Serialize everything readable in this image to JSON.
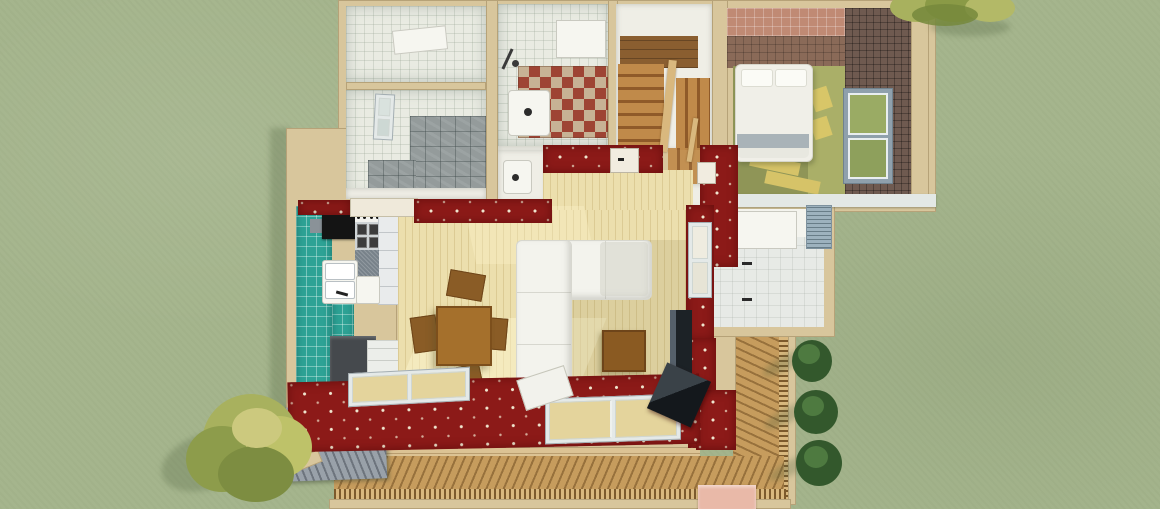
{
  "meta": {
    "title": "3D dollhouse top view rendering of a single-storey house on a lawn",
    "view": "top-down cutaway architectural render",
    "canvas": {
      "width": 1160,
      "height": 509
    }
  },
  "palette": {
    "grass": "#a5b58d",
    "wall_beige": "#d8c69c",
    "wall_white": "#efeee6",
    "red_wall": "#8c1a18",
    "red_dot": "#efe6cf",
    "tile_wall": "#e9ebe2",
    "stone_floor": "#949b9b",
    "teal_floor": "#2da295",
    "wood_floor": "#ecdfad",
    "bedroom_floor": "#8f9557",
    "bedroom_floor_light": "#aaaf68",
    "bedroom_wall": "#6f5a50",
    "bedroom_wall_mid": "#8a6a58",
    "bedroom_wall_top": "#c08a74",
    "stair_light": "#c08a4a",
    "stair_dark": "#8f5a29",
    "stair_landing": "#8a5e30",
    "deck_wood": "#c69c5d",
    "deck_plank": "#dcc394",
    "railing_dark": "#7c5a2c",
    "railing_light": "#d9b87e",
    "roof_gray": "#99a1a9",
    "sofa_white": "#f3f3ed",
    "sofa_edge": "#d7d7cf",
    "table_wood": "#a5702c",
    "chair_wood": "#8a5c26",
    "coffee_wood": "#8a5a22",
    "checker_red": "#9e4434",
    "checker_tan": "#c7b295",
    "window_frame": "#e4e9e8",
    "glass_warm": "#e4d49c",
    "glass_green": "#9aab64",
    "counter_gray": "#78828a",
    "appliance_dark": "#45494d",
    "step_pink": "#e9b9a8",
    "eave_white": "#e3e8e5",
    "tree_yellow": "#a8b15e",
    "tree_yellow_dark": "#7d8d41",
    "bush_green": "#33582c",
    "bush_green_light": "#4e7a40"
  },
  "scene": {
    "environment": {
      "ground": "lawn",
      "large_tree_count": 1,
      "small_canopy_count": 1,
      "bush_count": 3
    },
    "house": {
      "storeys_visible": 1,
      "rooms": [
        {
          "id": "utility-room",
          "label": "utility room (white tile, skylight)"
        },
        {
          "id": "laundry-room",
          "label": "second utility room (stone floor, window)"
        },
        {
          "id": "bathroom",
          "label": "bathroom (checker floor, shower, sink)"
        },
        {
          "id": "wc",
          "label": "small WC with washbasin"
        },
        {
          "id": "staircase",
          "label": "L-shaped wooden staircase with landing"
        },
        {
          "id": "hallway",
          "label": "entry hallway"
        },
        {
          "id": "bedroom",
          "label": "bedroom (double bed, plaid walls, window)"
        },
        {
          "id": "walk-in-closet",
          "label": "closet / storage room with cabinet"
        },
        {
          "id": "kitchen",
          "label": "kitchen (teal tile floor, counters, cooktop)"
        },
        {
          "id": "living-dining-room",
          "label": "living-dining room (wood floor)"
        },
        {
          "id": "veranda-deck",
          "label": "wooden deck with balustrade"
        }
      ],
      "furniture": [
        "double-bed",
        "sectional-sofa",
        "coffee-table",
        "dining-table",
        "dining-chair x4",
        "kitchen-counter",
        "cooktop",
        "kitchen-sink",
        "bathroom-sink",
        "wc-washbasin",
        "wall-cabinet",
        "tv-panel",
        "dark-storage-box"
      ],
      "window_count_visible": 7,
      "wall_finish": "dark red wallpaper with cream dot pattern on cut walls"
    }
  }
}
